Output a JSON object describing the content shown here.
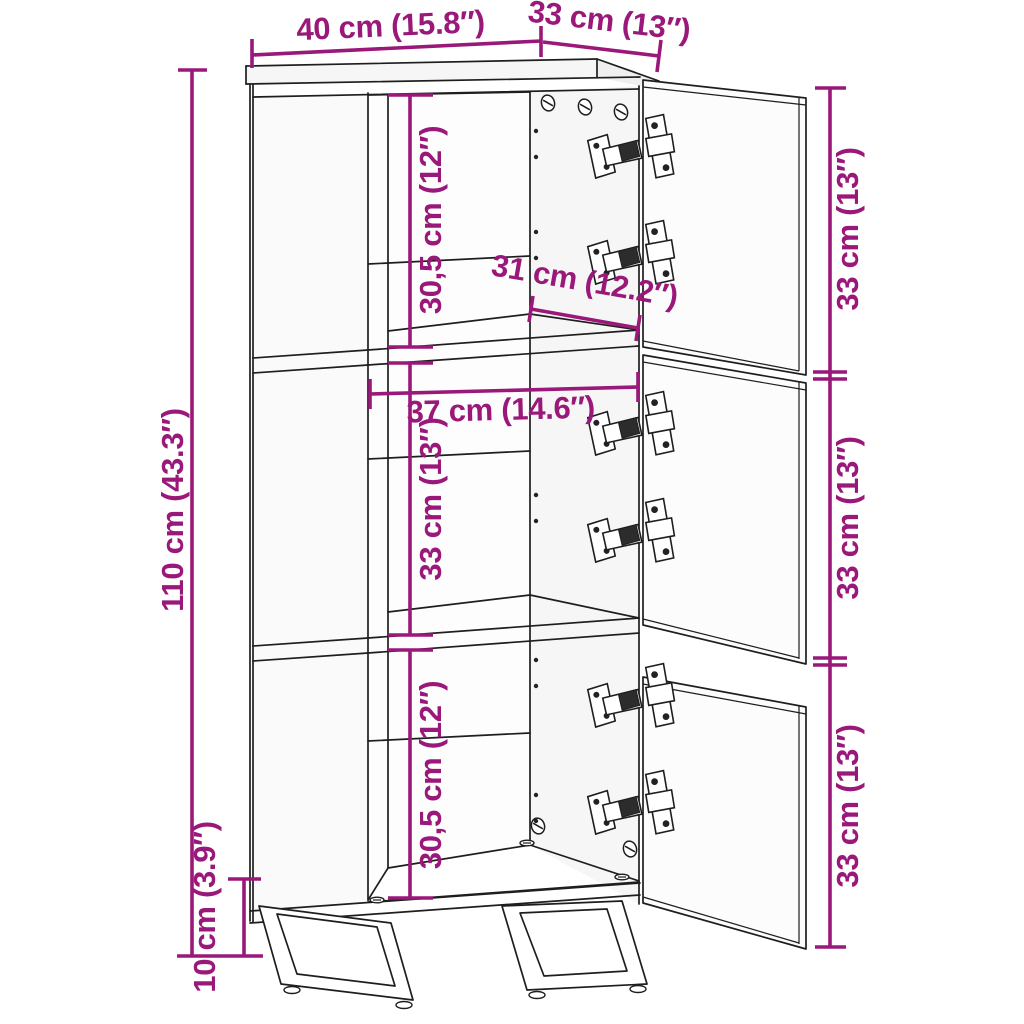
{
  "diagram_title": "Cabinet dimension drawing",
  "colors": {
    "dimension_accent": "#9A1879",
    "line": "#1E1E1E",
    "background": "#FFFFFF"
  },
  "dims": {
    "top_width": "40 cm (15.8″)",
    "depth": "33 cm (13″)",
    "total_height": "110 cm (43.3″)",
    "upper_compartment_height": "30,5 cm (12″)",
    "interior_depth": "31 cm (12.2″)",
    "interior_width": "37 cm (14.6″)",
    "middle_compartment_height": "33 cm (13″)",
    "lower_compartment_height": "30,5 cm (12″)",
    "leg_height": "10 cm (3.9″)",
    "door_top_height": "33 cm (13″)",
    "door_middle_height": "33 cm (13″)",
    "door_bottom_height": "33 cm (13″)"
  }
}
